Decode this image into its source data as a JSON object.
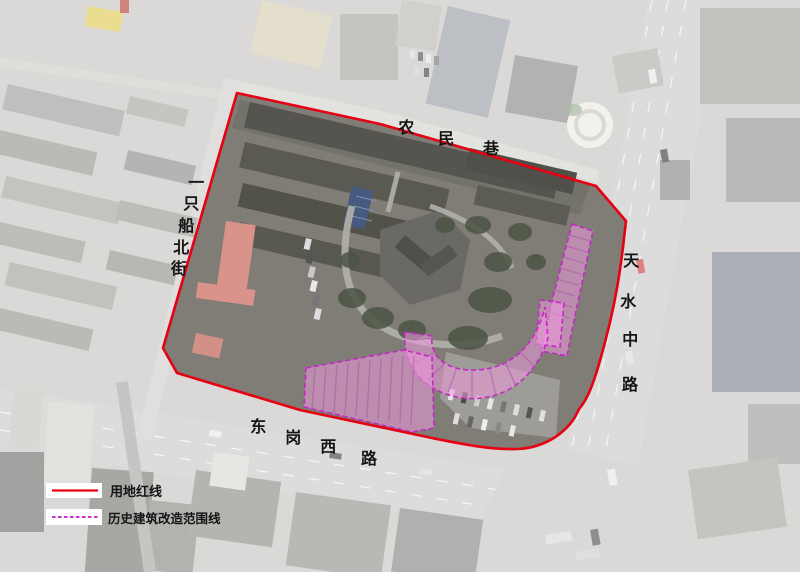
{
  "map": {
    "streets": {
      "top": {
        "name": "农民巷",
        "chars": [
          "农",
          "民",
          "巷"
        ]
      },
      "left": {
        "name": "一只船北街",
        "chars": [
          "一",
          "只",
          "船",
          "北",
          "街"
        ]
      },
      "right": {
        "name": "天水中路",
        "chars": [
          "天",
          "水",
          "中",
          "路"
        ]
      },
      "bottom": {
        "name": "东岗西路",
        "chars": [
          "东",
          "岗",
          "西",
          "路"
        ]
      }
    },
    "colors": {
      "boundary_red": "#e60012",
      "highlight_magenta": "#cc2fcf",
      "highlight_fill": "#ee9ade"
    }
  },
  "legend": {
    "items": [
      {
        "label": "用地红线",
        "swatch": "red-solid-line"
      },
      {
        "label": "历史建筑改造范围线",
        "swatch": "magenta-dashed-line"
      }
    ]
  }
}
